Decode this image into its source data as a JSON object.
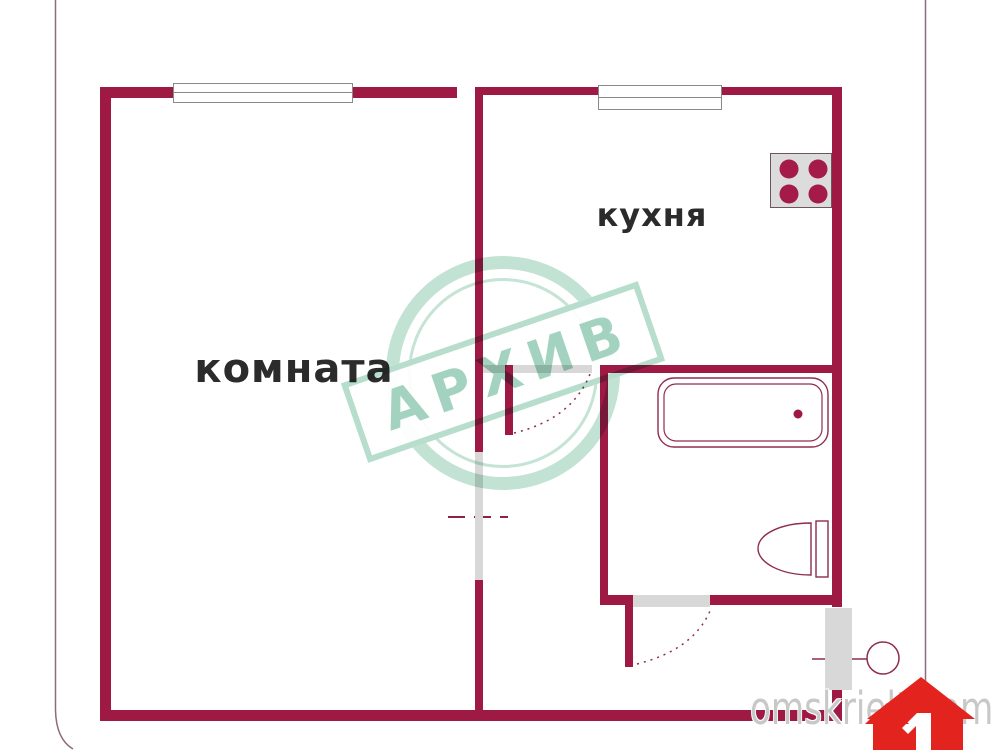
{
  "plan": {
    "rooms": [
      {
        "id": "room",
        "label": "комната"
      },
      {
        "id": "kitchen",
        "label": "кухня"
      }
    ]
  },
  "watermark": {
    "stamp_text": "АРХИВ"
  },
  "footer": {
    "site_text": "omskrielt.com"
  },
  "colors": {
    "bg": "#ffffff",
    "wall": "#9e1a45",
    "burner": "#a41a48",
    "line": "#8f2c50",
    "dash": "#8e2247",
    "gray_door": "#d8d8d8",
    "window_border": "#8a8a8a",
    "label": "#2b2b2b",
    "stove_bg": "#dcdcdc",
    "stove_border": "#6b5560",
    "mint": "#b7ddcc",
    "mint_text": "#a3d3c0",
    "site_text": "#c8c8c8",
    "logo_red": "#e3231e",
    "border_line": "#8d6b7c"
  }
}
